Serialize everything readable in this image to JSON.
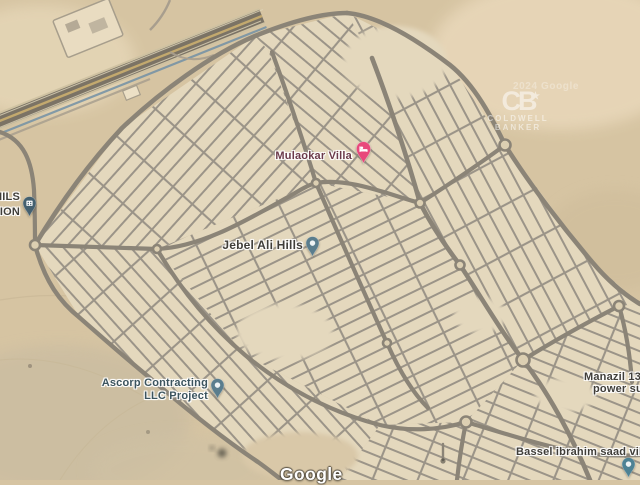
{
  "map": {
    "labels": {
      "mulaokar": {
        "text": "Mulaokar Villa",
        "color": "#6b3a4a"
      },
      "jebel_ali_hills": {
        "text": "Jebel Ali Hills",
        "color": "#403e39"
      },
      "ascorp": {
        "line1": "Ascorp Contracting",
        "line2": "LLC Project",
        "color": "#3c545e"
      },
      "station_cut": {
        "line1": "HILS",
        "line2": "TION",
        "color": "#403e39"
      },
      "manazil_cut": {
        "line1": "Manazil 132",
        "line2": "power su",
        "color": "#403e39"
      },
      "bassel": {
        "text": "Bassel ibrahim saad villa",
        "color": "#403e39"
      }
    },
    "pins": {
      "mulaokar": {
        "type": "lodging",
        "color": "#e8487b"
      },
      "jebel_ali_hills": {
        "type": "place",
        "color": "#5a7d8d"
      },
      "ascorp": {
        "type": "place",
        "color": "#5a7d8d"
      },
      "station": {
        "type": "building",
        "color": "#44606f"
      },
      "bassel": {
        "type": "place",
        "color": "#4d8294"
      }
    },
    "watermarks": {
      "coldwell": {
        "initials": "CB",
        "star": "★",
        "line1": "COLDWELL",
        "line2": "BANKER"
      },
      "faint_text": "2024 Google",
      "google": "Google"
    },
    "colors": {
      "desert": "#d6c4a2",
      "development": "#e4d8bd",
      "road": "#8b8477",
      "street": "#9b9488",
      "roundabout_fill": "#dccfb2",
      "highway_base": "#7b7365",
      "highway_stripe": "#c3a96e",
      "highway_lane": "#cfc2a2",
      "pipeline": "#7290a6"
    }
  }
}
